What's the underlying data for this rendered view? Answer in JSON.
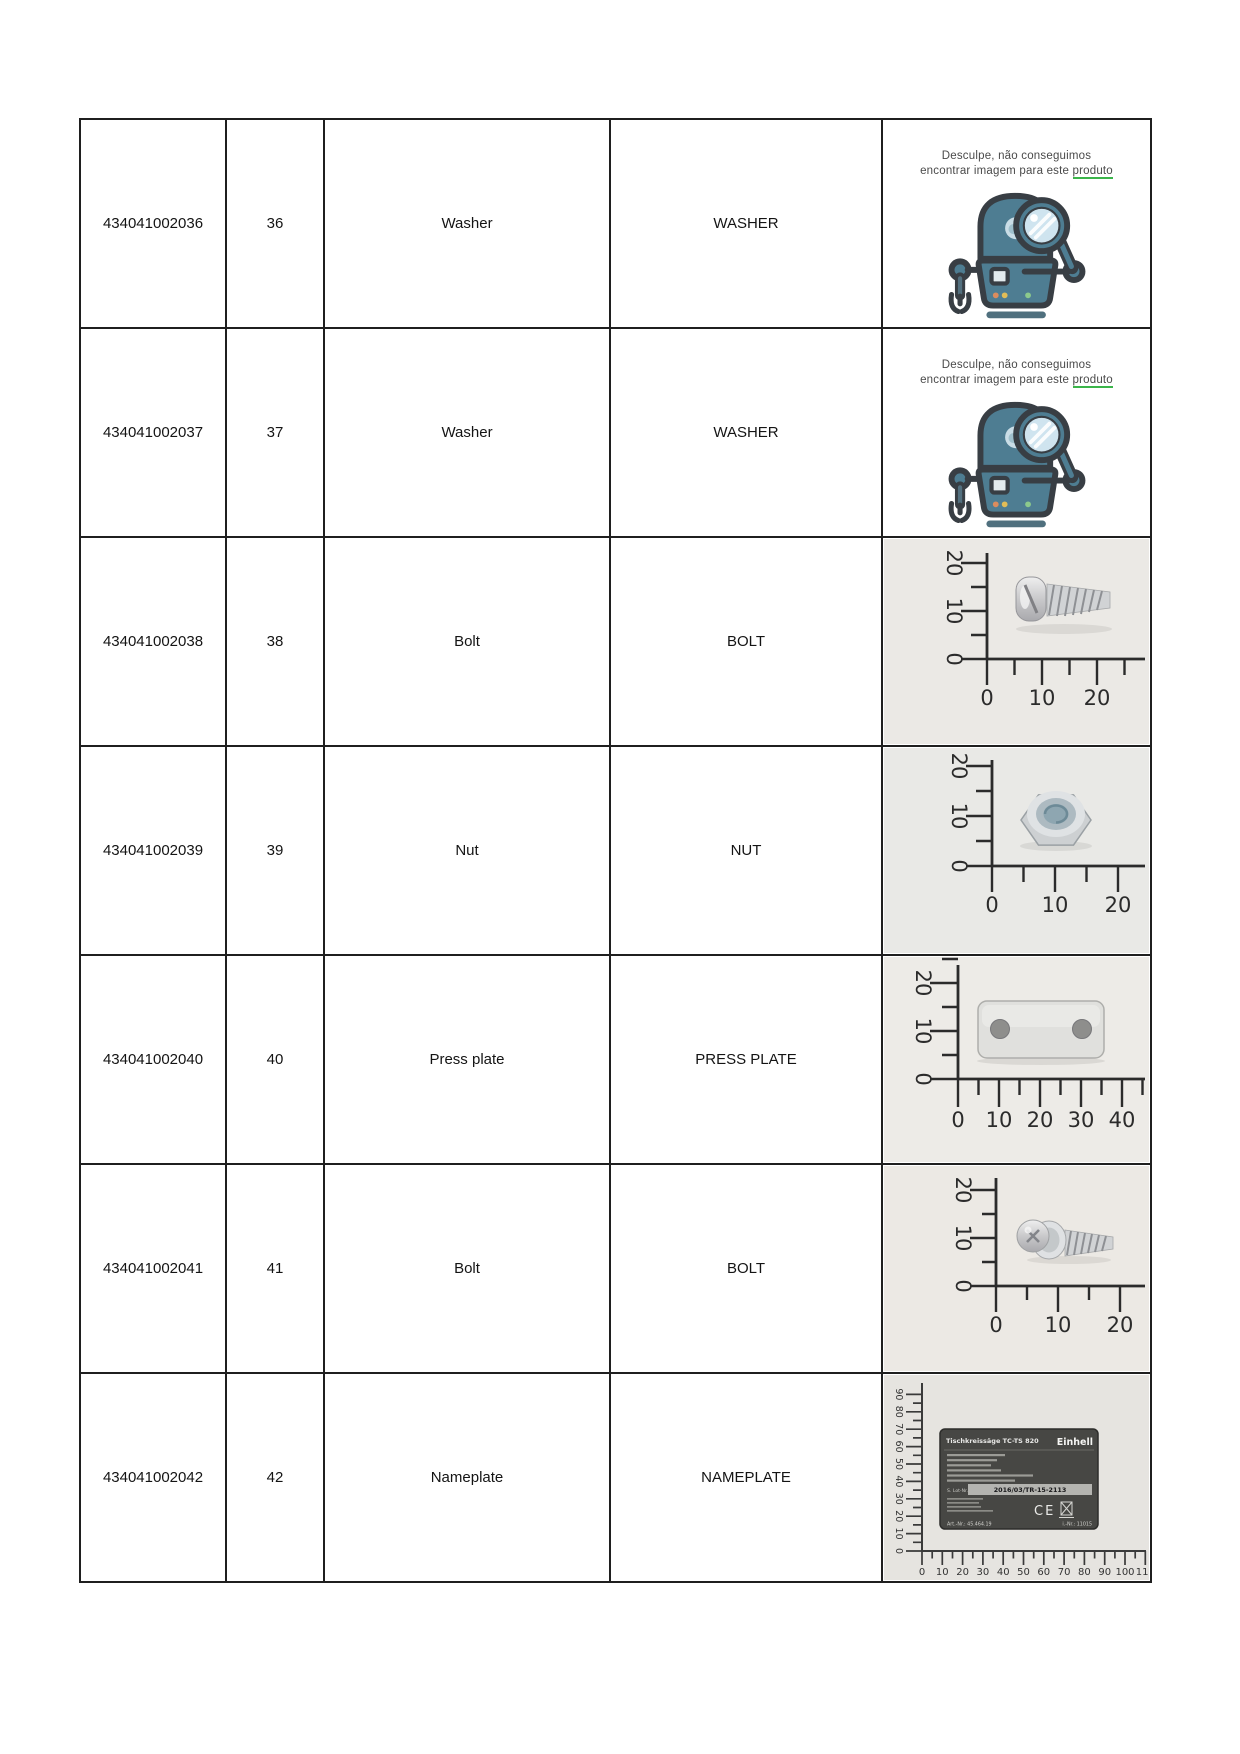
{
  "page": {
    "background": "#ffffff"
  },
  "colors": {
    "table_border": "#1f1f1f",
    "robot_teal": "#4e7d92",
    "robot_outline": "#383e44",
    "lens_blue": "#cfe4ef",
    "underline_green": "#3bb54a",
    "photo_background": "#eae8e4",
    "ruler_ink": "#2b2b2b"
  },
  "no_image": {
    "line1": "Desculpe, não conseguimos",
    "line2_prefix": "encontrar imagem para este ",
    "line2_underlined": "produto"
  },
  "rulers": {
    "xy20": {
      "x": [
        "0",
        "10",
        "20"
      ],
      "y": [
        "0",
        "10",
        "20"
      ]
    },
    "x40": {
      "x": [
        "0",
        "10",
        "20",
        "30",
        "40"
      ],
      "y": [
        "0",
        "10",
        "20"
      ]
    },
    "nameplate": {
      "x": [
        "0",
        "10",
        "20",
        "30",
        "40",
        "50",
        "60",
        "70",
        "80",
        "90",
        "100",
        "110"
      ],
      "y": [
        "0",
        "10",
        "20",
        "30",
        "40",
        "50",
        "60",
        "70",
        "80",
        "90"
      ]
    }
  },
  "nameplate_label": {
    "title": "Tischkreissäge TC-TS 820",
    "brand": "Einhell",
    "lot_label": "S. Lot-Nr.",
    "serial": "2016/03/TR-15-2113",
    "ce": "CE",
    "art_nr": "Art.-Nr.: 45.464.19",
    "i_nr": "i.-Nr.: 11015"
  },
  "rows": [
    {
      "part_number": "434041002036",
      "position": "36",
      "description": "Washer",
      "description_upper": "WASHER",
      "image": "no-image-placeholder"
    },
    {
      "part_number": "434041002037",
      "position": "37",
      "description": "Washer",
      "description_upper": "WASHER",
      "image": "no-image-placeholder"
    },
    {
      "part_number": "434041002038",
      "position": "38",
      "description": "Bolt",
      "description_upper": "BOLT",
      "image": "bolt-ruler-photo"
    },
    {
      "part_number": "434041002039",
      "position": "39",
      "description": "Nut",
      "description_upper": "NUT",
      "image": "nut-ruler-photo"
    },
    {
      "part_number": "434041002040",
      "position": "40",
      "description": "Press plate",
      "description_upper": "PRESS PLATE",
      "image": "press-plate-ruler-photo"
    },
    {
      "part_number": "434041002041",
      "position": "41",
      "description": "Bolt",
      "description_upper": "BOLT",
      "image": "bolt-washer-ruler-photo"
    },
    {
      "part_number": "434041002042",
      "position": "42",
      "description": "Nameplate",
      "description_upper": "NAMEPLATE",
      "image": "nameplate-ruler-photo"
    }
  ]
}
